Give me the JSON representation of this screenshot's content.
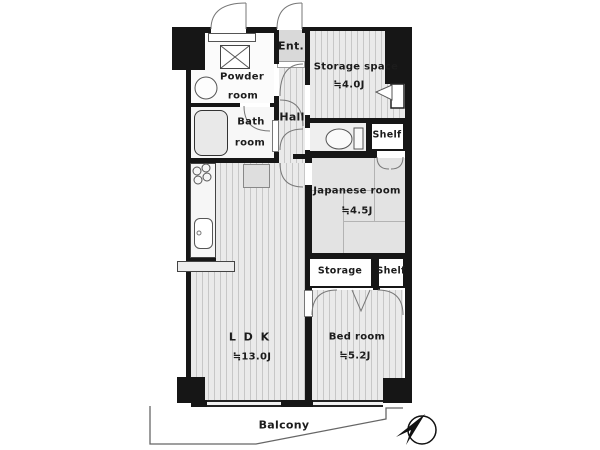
{
  "plan": {
    "rooms": {
      "ldk": {
        "label": "L D K",
        "size": "≒13.0J"
      },
      "bedroom": {
        "label": "Bed room",
        "size": "≒5.2J"
      },
      "japanese": {
        "label": "Japanese room",
        "size": "≒4.5J"
      },
      "storage_space": {
        "label": "Storage space",
        "size": "≒4.0J"
      },
      "powder": {
        "line1": "Powder",
        "line2": "room"
      },
      "bath": {
        "line1": "Bath",
        "line2": "room"
      },
      "hall": {
        "label": "Hall"
      },
      "entrance": {
        "label": "Ent."
      },
      "balcony": {
        "label": "Balcony"
      },
      "wc_shelf": {
        "label": "Shelf"
      },
      "bedroom_storage": {
        "label": "Storage"
      },
      "bedroom_shelf": {
        "label": "Shelf"
      }
    },
    "colors": {
      "wall": "#161616",
      "tatami": "#e3e3e3",
      "stripe_floor": "#eaeaea",
      "entrance_tile": "#d9d9d9",
      "compass": "#111111"
    },
    "icons": {
      "north_arrow": "north-arrow"
    }
  }
}
